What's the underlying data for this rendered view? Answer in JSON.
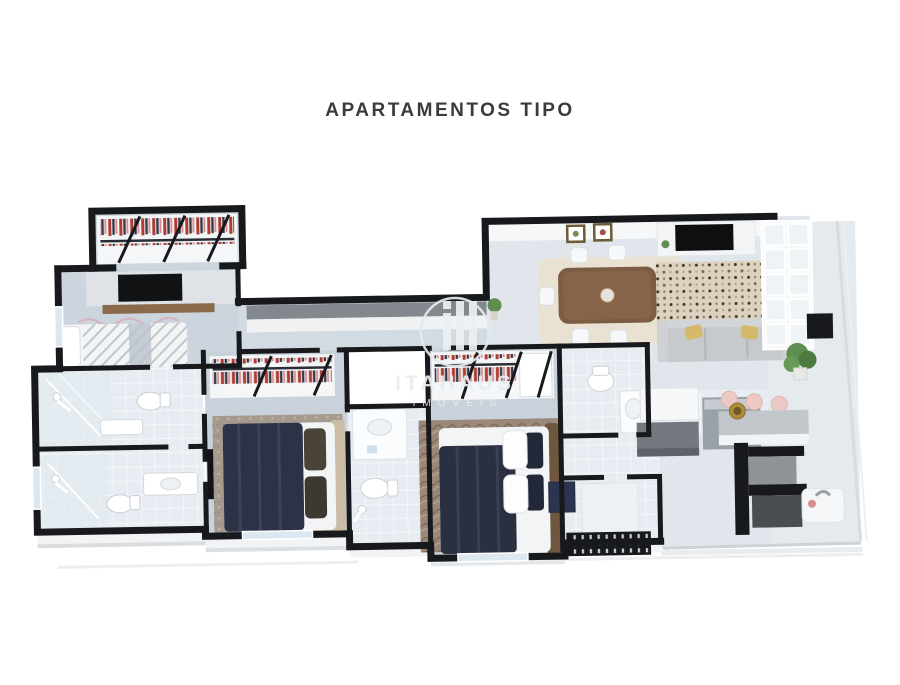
{
  "page": {
    "background": "#ffffff"
  },
  "header": {
    "title": "APARTAMENTOS TIPO",
    "color": "#3b3b3d"
  },
  "watermark": {
    "brand": "ITAHAUS",
    "subtitle": "IMÓVEIS",
    "logo": "ih-monogram-circle-icon",
    "color": "#e9edef"
  },
  "floorplan": {
    "type": "3d-top-down-apartment-render",
    "palette": {
      "wall": "#17191c",
      "floor_bedroom": "#c9d2da",
      "floor_living": "#e0e6eb",
      "floor_tile": "#e6ecf1",
      "bed_duvet_navy": "#2d3347",
      "headboard_tan": "#cbbda5",
      "headboard_brown": "#6f563f",
      "wood_table": "#7d5c44",
      "wood_shelf": "#8a6a4a",
      "sofa_gray": "#c6cacd",
      "pillow_yellow": "#d4b96a",
      "rug_beige": "#ddd2c0",
      "rug_gray": "#a69a8e",
      "rug_brown": "#9b8878",
      "clothes_red": "#b23a32",
      "stool_pink": "#edc9c5",
      "plant_green": "#5f8d4f",
      "counter_gray": "#73797f",
      "glass": "#dce8f0",
      "slab": "#dadde0"
    },
    "rooms": [
      {
        "name": "walk-in-closet",
        "items": [
          "wardrobe-red-clothes"
        ]
      },
      {
        "name": "master-bedroom",
        "items": [
          "tv-panel",
          "wood-shelf",
          "double-bed-striped",
          "wall-decal"
        ]
      },
      {
        "name": "master-bathroom",
        "items": [
          "shower",
          "toilet",
          "sink"
        ]
      },
      {
        "name": "second-bathroom",
        "items": [
          "shower",
          "toilet",
          "sink-counter"
        ]
      },
      {
        "name": "hallway",
        "items": [
          "long-cabinet",
          "plant"
        ]
      },
      {
        "name": "bedroom-2",
        "items": [
          "wardrobe-red-clothes",
          "navy-double-bed",
          "gray-rug",
          "wall-tv"
        ]
      },
      {
        "name": "bathroom-middle",
        "items": [
          "sink-counter",
          "toilet",
          "towel-rail"
        ]
      },
      {
        "name": "bedroom-3",
        "items": [
          "wardrobe-red-clothes",
          "navy-double-bed",
          "brown-rug"
        ]
      },
      {
        "name": "social-bathroom",
        "items": [
          "toilet",
          "sink-counter"
        ]
      },
      {
        "name": "living-dining-room",
        "items": [
          "framed-pictures",
          "dining-table",
          "six-chairs",
          "beige-rug",
          "patterned-rug",
          "tv-unit",
          "sofa-yellow-pillows",
          "shelf-window-grid",
          "column",
          "plant"
        ]
      },
      {
        "name": "kitchen",
        "items": [
          "island",
          "gray-counters"
        ]
      },
      {
        "name": "service-area",
        "items": [
          "washer",
          "door",
          "stair-grate"
        ]
      },
      {
        "name": "gourmet-balcony",
        "items": [
          "pink-stools",
          "bar-counter",
          "gold-pan",
          "grill",
          "sink",
          "glass-railing"
        ]
      }
    ]
  }
}
